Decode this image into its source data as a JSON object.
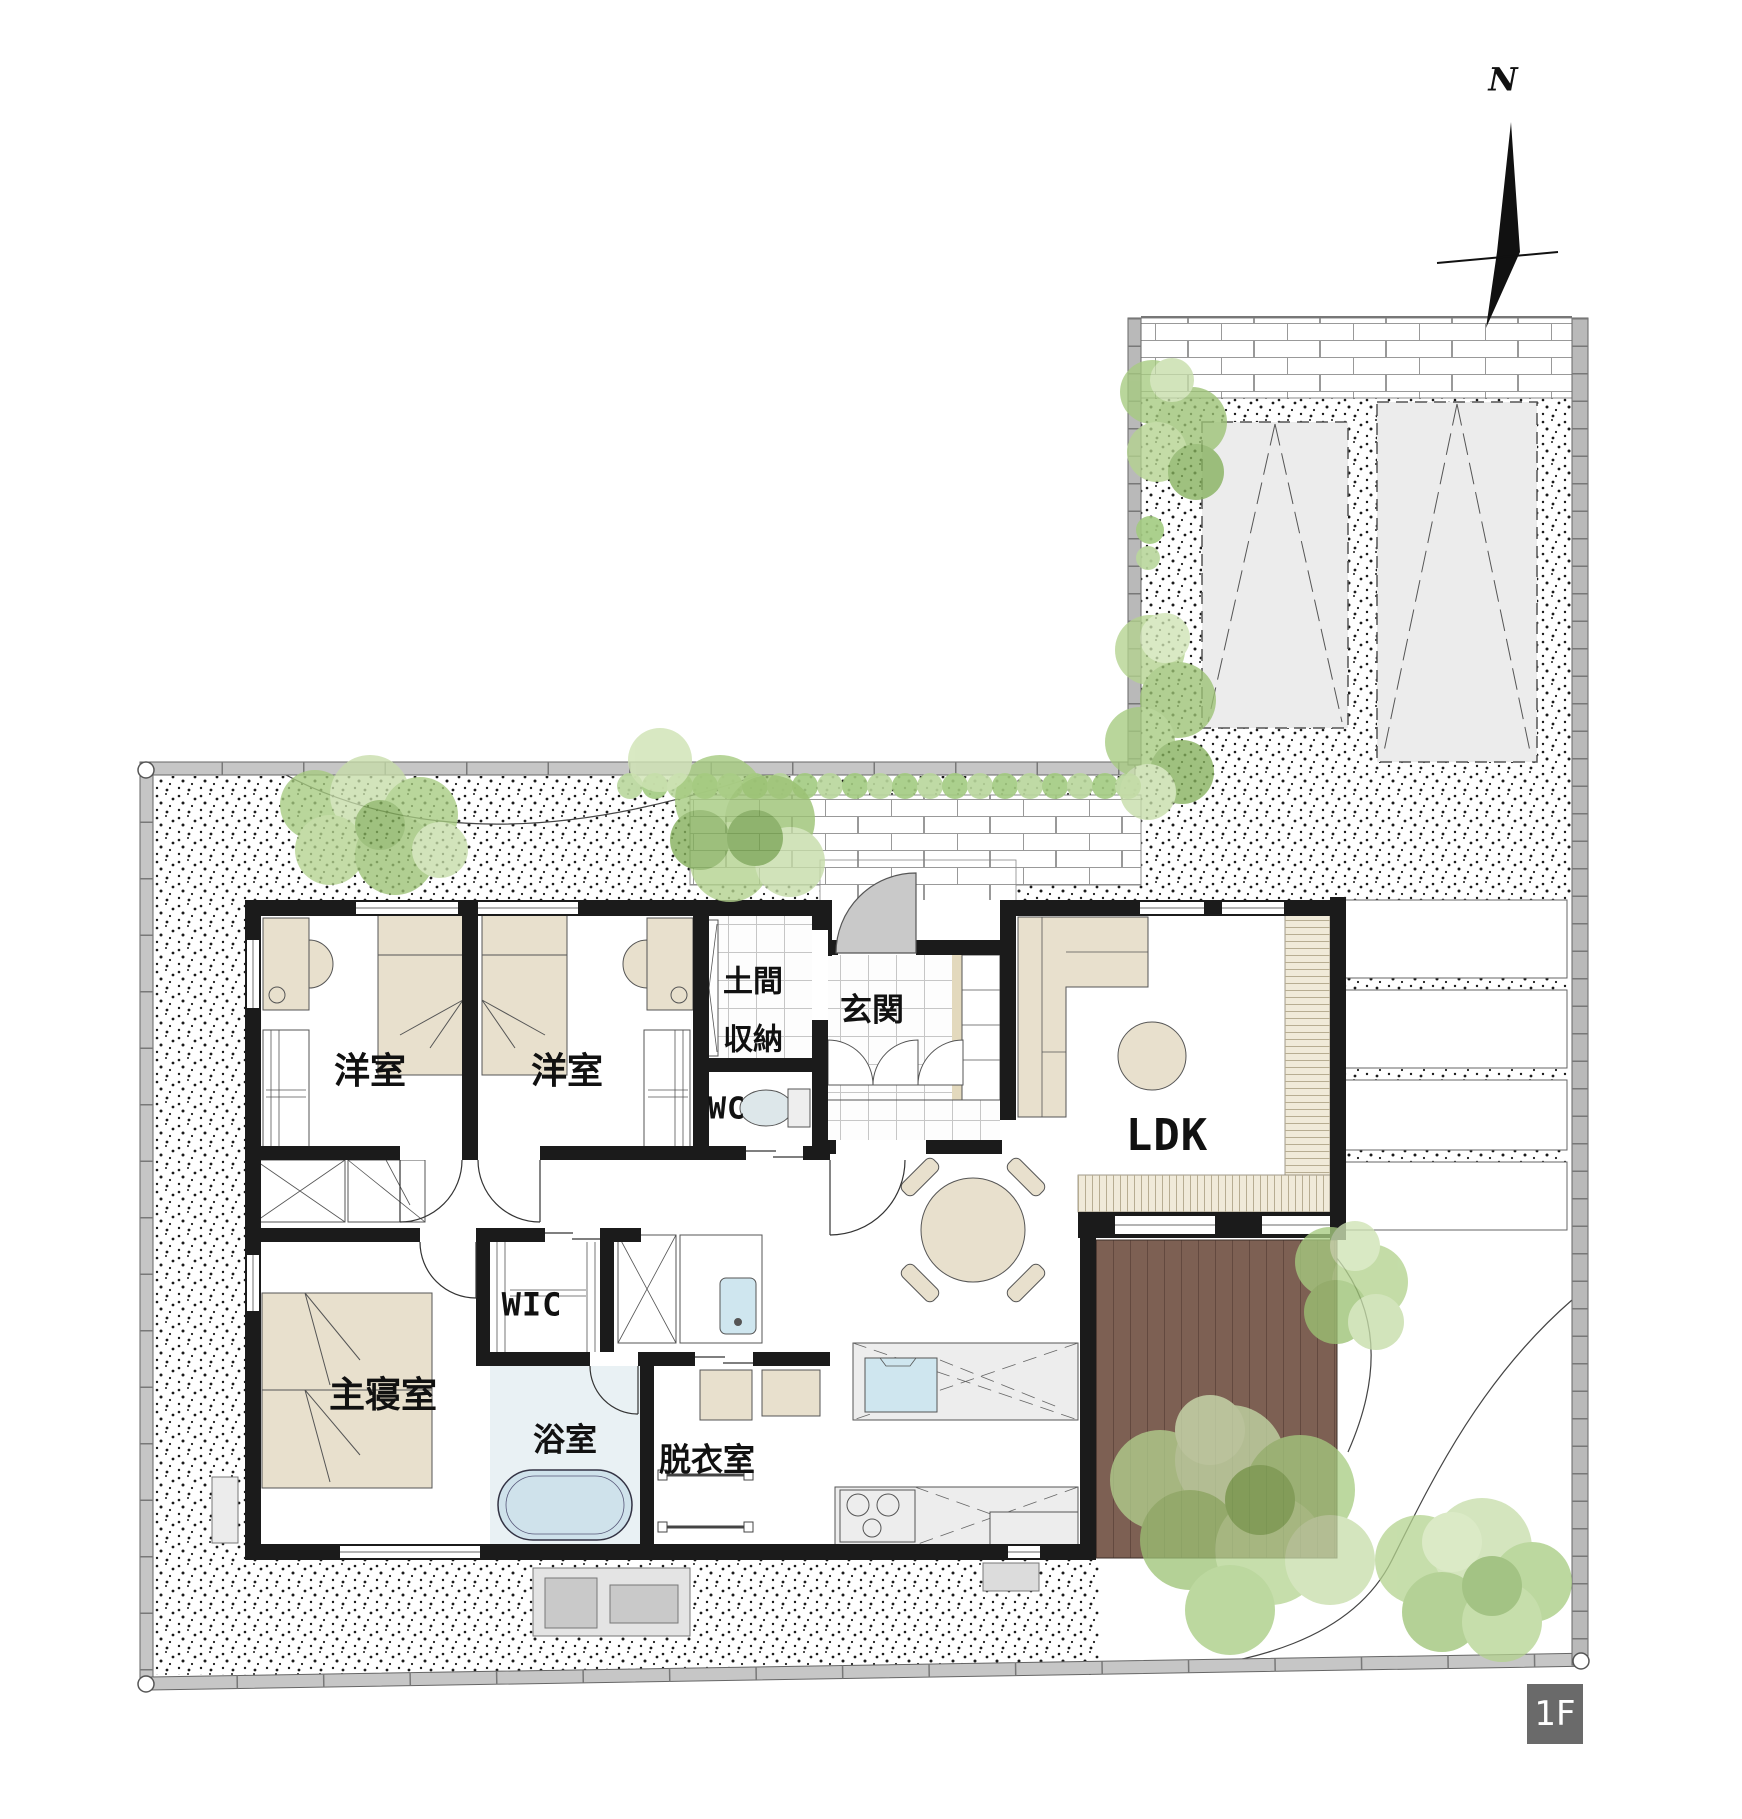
{
  "floor_plan": {
    "floor_badge": "1F",
    "compass_north": "N",
    "rooms": {
      "bedroom_west": {
        "label": "洋室"
      },
      "bedroom_east": {
        "label": "洋室"
      },
      "doma_storage": {
        "line1": "土間",
        "line2": "収納"
      },
      "entrance": {
        "label": "玄関"
      },
      "toilet": {
        "label": "WC"
      },
      "ldk": {
        "label": "LDK"
      },
      "wic": {
        "label": "WIC"
      },
      "master_bedroom": {
        "label": "主寝室"
      },
      "bathroom": {
        "label": "浴室"
      },
      "dressing_room": {
        "label": "脱衣室"
      }
    },
    "colors": {
      "wall": "#1b1b1b",
      "furniture_beige": "#e8e0cd",
      "bathroom_floor": "#e9f1f4",
      "bathtub": "#cfe2eb",
      "sink_blue": "#cfe6ef",
      "deck_brown": "#7d6053",
      "engawa_wood": "#f0ead9",
      "tree_light": "#c6dda9",
      "tree_mid": "#a6cb80",
      "tree_dark": "#85b05c",
      "fence_gray": "#c6c6c6",
      "block_wall": "#b9b9b9",
      "parking_stall": "#ececec",
      "counter_gray": "#ededed",
      "entry_door_gray": "#c9c9c9",
      "badge_bg": "#6a6a6a"
    }
  }
}
